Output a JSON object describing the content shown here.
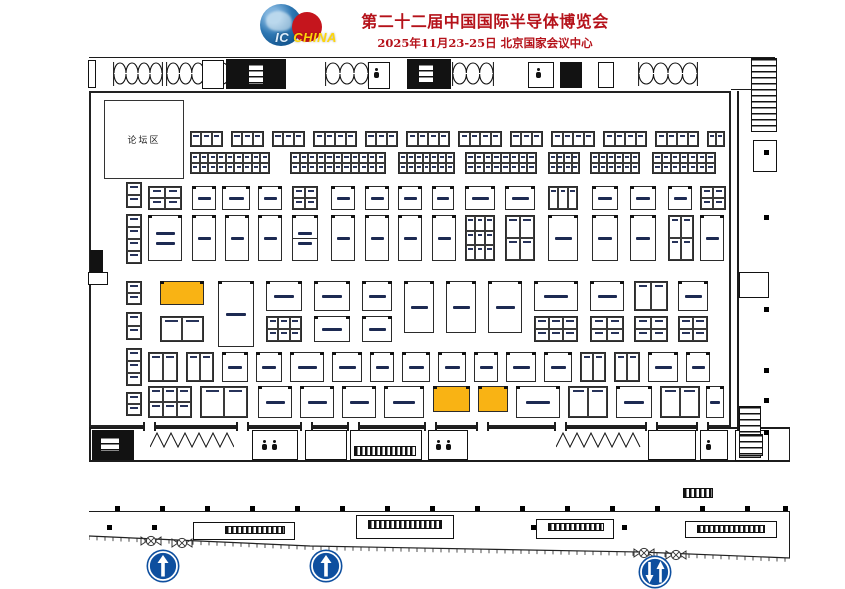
{
  "header": {
    "logo_ic": "IC ",
    "logo_china": "CHINA",
    "title": "第二十二届中国国际半导体博览会",
    "subtitle": "2025年11月23-25日  北京国家会议中心"
  },
  "colors": {
    "title_red": "#b5121a",
    "highlight": "#f9b314",
    "sign_blue": "#0e4f9f",
    "line": "#1c1c1c"
  },
  "plan": {
    "forum": {
      "label": "论坛区",
      "x": 104,
      "y": 100,
      "w": 78,
      "h": 77
    },
    "scale_label": "100m",
    "scale_pos": {
      "x": 386,
      "y": 450
    },
    "hall": {
      "x": 89,
      "y": 91,
      "w": 642,
      "h": 336
    },
    "strips": [
      {
        "x": 126,
        "y": 182,
        "w": 16,
        "h": 26,
        "rows": 2
      },
      {
        "x": 126,
        "y": 214,
        "w": 16,
        "h": 50,
        "rows": 4
      },
      {
        "x": 126,
        "y": 281,
        "w": 16,
        "h": 24,
        "rows": 2
      },
      {
        "x": 126,
        "y": 312,
        "w": 16,
        "h": 28,
        "rows": 2
      },
      {
        "x": 126,
        "y": 348,
        "w": 16,
        "h": 38,
        "rows": 3
      },
      {
        "x": 126,
        "y": 392,
        "w": 16,
        "h": 24,
        "rows": 2
      }
    ],
    "rows": [
      {
        "y": 131,
        "h": 16,
        "groups": [
          {
            "x": 190,
            "cols": 3
          },
          {
            "x": 231,
            "cols": 3
          },
          {
            "x": 272,
            "cols": 3
          },
          {
            "x": 313,
            "cols": 4
          },
          {
            "x": 365,
            "cols": 3
          },
          {
            "x": 406,
            "cols": 4
          },
          {
            "x": 458,
            "cols": 4
          },
          {
            "x": 510,
            "cols": 3
          },
          {
            "x": 551,
            "cols": 4
          },
          {
            "x": 603,
            "cols": 4
          },
          {
            "x": 655,
            "cols": 4
          },
          {
            "x": 707,
            "cols": 2,
            "cw": 9
          }
        ]
      },
      {
        "y": 152,
        "h": 22,
        "groups": [
          {
            "x": 190,
            "w": 80,
            "cols": 9,
            "rows": 2
          },
          {
            "x": 290,
            "w": 96,
            "cols": 11,
            "rows": 2
          },
          {
            "x": 398,
            "w": 57,
            "cols": 7,
            "rows": 2
          },
          {
            "x": 465,
            "w": 72,
            "cols": 8,
            "rows": 2
          },
          {
            "x": 548,
            "w": 32,
            "cols": 4,
            "rows": 2
          },
          {
            "x": 590,
            "w": 50,
            "cols": 6,
            "rows": 2
          },
          {
            "x": 652,
            "w": 64,
            "cols": 7,
            "rows": 2
          }
        ]
      },
      {
        "y": 186,
        "h": 24,
        "groups": [
          {
            "x": 148,
            "w": 34,
            "cols": 2,
            "rows": 2
          },
          {
            "x": 192,
            "w": 24,
            "lbl": 1
          },
          {
            "x": 222,
            "w": 28,
            "lbl": 1
          },
          {
            "x": 258,
            "w": 24,
            "lbl": 1
          },
          {
            "x": 292,
            "w": 26,
            "cols": 2,
            "rows": 2
          },
          {
            "x": 331,
            "w": 24,
            "lbl": 1
          },
          {
            "x": 365,
            "w": 24,
            "lbl": 1
          },
          {
            "x": 398,
            "w": 24,
            "lbl": 1
          },
          {
            "x": 432,
            "w": 22,
            "lbl": 1
          },
          {
            "x": 465,
            "w": 30,
            "lbl": 1
          },
          {
            "x": 505,
            "w": 30,
            "lbl": 1
          },
          {
            "x": 548,
            "w": 30,
            "cols": 3,
            "rows": 1
          },
          {
            "x": 592,
            "w": 26,
            "lbl": 1
          },
          {
            "x": 630,
            "w": 26,
            "lbl": 1
          },
          {
            "x": 668,
            "w": 24,
            "lbl": 1
          },
          {
            "x": 700,
            "w": 26,
            "cols": 2,
            "rows": 2
          }
        ]
      },
      {
        "y": 215,
        "h": 46,
        "groups": [
          {
            "x": 148,
            "w": 34,
            "lbl": 2
          },
          {
            "x": 192,
            "w": 24,
            "lbl": 1
          },
          {
            "x": 225,
            "w": 24,
            "lbl": 1
          },
          {
            "x": 258,
            "w": 24,
            "lbl": 1
          },
          {
            "x": 292,
            "w": 26,
            "lbl": 2,
            "split": true
          },
          {
            "x": 331,
            "w": 24,
            "lbl": 1
          },
          {
            "x": 365,
            "w": 24,
            "lbl": 1
          },
          {
            "x": 398,
            "w": 24,
            "lbl": 1
          },
          {
            "x": 432,
            "w": 24,
            "lbl": 1
          },
          {
            "x": 465,
            "w": 30,
            "cols": 3,
            "rows": 3
          },
          {
            "x": 505,
            "w": 30,
            "cols": 2,
            "rows": 2
          },
          {
            "x": 548,
            "w": 30,
            "lbl": 1
          },
          {
            "x": 592,
            "w": 26,
            "lbl": 1
          },
          {
            "x": 630,
            "w": 26,
            "lbl": 1
          },
          {
            "x": 668,
            "w": 26,
            "cols": 2,
            "rows": 2
          },
          {
            "x": 700,
            "w": 24,
            "lbl": 1
          }
        ]
      },
      {
        "y": 281,
        "h": 30,
        "groups": [
          {
            "x": 160,
            "w": 44,
            "h": 24,
            "hl": true
          },
          {
            "x": 218,
            "w": 36,
            "h": 66,
            "lbl": 1
          },
          {
            "x": 266,
            "w": 36,
            "lbl": 1
          },
          {
            "x": 314,
            "w": 36,
            "lbl": 1
          },
          {
            "x": 362,
            "w": 30,
            "lbl": 1
          },
          {
            "x": 404,
            "w": 30,
            "h": 52,
            "lbl": 1
          },
          {
            "x": 446,
            "w": 30,
            "h": 52,
            "lbl": 1
          },
          {
            "x": 488,
            "w": 34,
            "h": 52,
            "lbl": 1
          },
          {
            "x": 534,
            "w": 44,
            "lbl": 1
          },
          {
            "x": 590,
            "w": 34,
            "lbl": 1
          },
          {
            "x": 634,
            "w": 34,
            "cols": 2,
            "rows": 1
          },
          {
            "x": 678,
            "w": 30,
            "lbl": 1
          }
        ]
      },
      {
        "y": 316,
        "h": 26,
        "groups": [
          {
            "x": 160,
            "w": 44,
            "cols": 2,
            "rows": 1
          },
          {
            "x": 266,
            "w": 36,
            "cols": 3,
            "rows": 2
          },
          {
            "x": 314,
            "w": 36,
            "lbl": 1
          },
          {
            "x": 362,
            "w": 30,
            "lbl": 1
          },
          {
            "x": 534,
            "w": 44,
            "cols": 3,
            "rows": 2
          },
          {
            "x": 590,
            "w": 34,
            "cols": 2,
            "rows": 2
          },
          {
            "x": 634,
            "w": 34,
            "cols": 2,
            "rows": 2
          },
          {
            "x": 678,
            "w": 30,
            "cols": 2,
            "rows": 2
          }
        ]
      },
      {
        "y": 352,
        "h": 30,
        "groups": [
          {
            "x": 148,
            "w": 30,
            "cols": 2,
            "rows": 1
          },
          {
            "x": 186,
            "w": 28,
            "cols": 2,
            "rows": 1
          },
          {
            "x": 222,
            "w": 26,
            "lbl": 1
          },
          {
            "x": 256,
            "w": 26,
            "lbl": 1
          },
          {
            "x": 290,
            "w": 34,
            "lbl": 1
          },
          {
            "x": 332,
            "w": 30,
            "lbl": 1
          },
          {
            "x": 370,
            "w": 24,
            "lbl": 1
          },
          {
            "x": 402,
            "w": 28,
            "lbl": 1
          },
          {
            "x": 438,
            "w": 28,
            "lbl": 1
          },
          {
            "x": 474,
            "w": 24,
            "lbl": 1
          },
          {
            "x": 506,
            "w": 30,
            "lbl": 1
          },
          {
            "x": 544,
            "w": 28,
            "lbl": 1
          },
          {
            "x": 580,
            "w": 26,
            "cols": 2,
            "rows": 1
          },
          {
            "x": 614,
            "w": 26,
            "cols": 2,
            "rows": 1
          },
          {
            "x": 648,
            "w": 30,
            "lbl": 1
          },
          {
            "x": 686,
            "w": 24,
            "lbl": 1
          }
        ]
      },
      {
        "y": 386,
        "h": 32,
        "groups": [
          {
            "x": 148,
            "w": 44,
            "cols": 3,
            "rows": 2
          },
          {
            "x": 200,
            "w": 48,
            "cols": 2,
            "rows": 1
          },
          {
            "x": 258,
            "w": 34,
            "lbl": 1
          },
          {
            "x": 300,
            "w": 34,
            "lbl": 1
          },
          {
            "x": 342,
            "w": 34,
            "lbl": 1
          },
          {
            "x": 384,
            "w": 40,
            "lbl": 1
          },
          {
            "x": 433,
            "w": 37,
            "h": 26,
            "hl": true
          },
          {
            "x": 478,
            "w": 30,
            "h": 26,
            "hl": true
          },
          {
            "x": 516,
            "w": 44,
            "lbl": 1
          },
          {
            "x": 568,
            "w": 40,
            "cols": 2,
            "rows": 1
          },
          {
            "x": 616,
            "w": 36,
            "lbl": 1
          },
          {
            "x": 660,
            "w": 40,
            "cols": 2,
            "rows": 1
          },
          {
            "x": 706,
            "w": 18,
            "lbl": 1
          }
        ]
      }
    ],
    "arc_clusters": [
      {
        "x": 113,
        "y": 60,
        "w": 50
      },
      {
        "x": 166,
        "y": 60,
        "w": 64
      },
      {
        "x": 325,
        "y": 60,
        "w": 44
      },
      {
        "x": 452,
        "y": 60,
        "w": 42
      },
      {
        "x": 638,
        "y": 60,
        "w": 60
      }
    ],
    "top_dark": [
      {
        "x": 226,
        "y": 59,
        "w": 60,
        "h": 30
      },
      {
        "x": 407,
        "y": 59,
        "w": 44,
        "h": 30
      },
      {
        "x": 560,
        "y": 62,
        "w": 22,
        "h": 26
      }
    ],
    "top_boxes": [
      {
        "x": 202,
        "y": 60,
        "w": 22,
        "h": 29
      },
      {
        "x": 368,
        "y": 62,
        "w": 22,
        "h": 27
      },
      {
        "x": 528,
        "y": 62,
        "w": 26,
        "h": 26
      },
      {
        "x": 598,
        "y": 62,
        "w": 16,
        "h": 26
      },
      {
        "x": 88,
        "y": 60,
        "w": 8,
        "h": 28
      }
    ],
    "top_insets": [
      {
        "x": 248,
        "y": 63,
        "w": 16,
        "h": 22
      },
      {
        "x": 418,
        "y": 63,
        "w": 16,
        "h": 20
      }
    ],
    "persons": [
      {
        "x": 374,
        "y": 68
      },
      {
        "x": 536,
        "y": 68
      },
      {
        "x": 262,
        "y": 440
      },
      {
        "x": 272,
        "y": 440
      },
      {
        "x": 436,
        "y": 440
      },
      {
        "x": 446,
        "y": 440
      },
      {
        "x": 706,
        "y": 440
      }
    ],
    "bottom_dark": [
      {
        "x": 92,
        "y": 430,
        "w": 42,
        "h": 30
      }
    ],
    "bottom_boxes": [
      {
        "x": 252,
        "y": 430,
        "w": 46,
        "h": 30
      },
      {
        "x": 305,
        "y": 430,
        "w": 42,
        "h": 30
      },
      {
        "x": 350,
        "y": 430,
        "w": 72,
        "h": 30
      },
      {
        "x": 428,
        "y": 430,
        "w": 40,
        "h": 30
      },
      {
        "x": 648,
        "y": 430,
        "w": 48,
        "h": 30
      },
      {
        "x": 700,
        "y": 430,
        "w": 28,
        "h": 30
      },
      {
        "x": 735,
        "y": 430,
        "w": 34,
        "h": 31
      }
    ],
    "bottom_stripes": [
      {
        "x": 354,
        "y": 446,
        "w": 62,
        "h": 10
      },
      {
        "x": 683,
        "y": 488,
        "w": 30,
        "h": 10
      }
    ],
    "rung_blocks": [
      {
        "x": 751,
        "y": 58,
        "w": 26,
        "h": 74
      },
      {
        "x": 739,
        "y": 406,
        "w": 22,
        "h": 52
      },
      {
        "x": 100,
        "y": 436,
        "w": 20,
        "h": 16
      },
      {
        "x": 739,
        "y": 434,
        "w": 24,
        "h": 22
      }
    ],
    "right_boxes": [
      {
        "x": 753,
        "y": 140,
        "w": 24,
        "h": 32
      },
      {
        "x": 739,
        "y": 272,
        "w": 30,
        "h": 26
      }
    ],
    "right_columns_y": [
      150,
      215,
      307,
      368,
      398,
      430
    ],
    "left_objects": {
      "dark": {
        "x": 90,
        "y": 250,
        "w": 13,
        "h": 22
      },
      "box": {
        "x": 88,
        "y": 272,
        "w": 20,
        "h": 13
      }
    },
    "zigzags": [
      {
        "x": 150,
        "y": 432,
        "w": 84,
        "h": 17
      },
      {
        "x": 556,
        "y": 432,
        "w": 88,
        "h": 17
      }
    ],
    "gap_ticks_x": [
      143,
      236,
      300,
      347,
      424,
      476,
      554,
      645,
      696
    ],
    "lines": [
      {
        "x": 89,
        "y": 57,
        "w": 686,
        "h": 1.2
      },
      {
        "x": 731,
        "y": 89,
        "w": 45,
        "h": 1.4
      },
      {
        "x": 737,
        "y": 91,
        "w": 1.5,
        "h": 370
      },
      {
        "x": 89,
        "y": 427,
        "w": 701,
        "h": 2
      },
      {
        "x": 89,
        "y": 460,
        "w": 701,
        "h": 1.5
      },
      {
        "x": 89,
        "y": 427,
        "w": 1.5,
        "h": 34
      },
      {
        "x": 788.5,
        "y": 427,
        "w": 1.5,
        "h": 34
      },
      {
        "x": 89,
        "y": 511,
        "w": 701,
        "h": 1.2
      },
      {
        "x": 788.8,
        "y": 511,
        "w": 1.2,
        "h": 47
      }
    ],
    "dots_row1_y": 506,
    "dots_row1": [
      115,
      160,
      205,
      250,
      295,
      340,
      385,
      430,
      475,
      520,
      565,
      610,
      655,
      700,
      745,
      783
    ],
    "dots_row2_y": 525,
    "dots_row2": [
      107,
      152,
      231,
      278,
      356,
      402,
      449,
      531,
      577,
      622,
      725,
      770
    ],
    "shelters": [
      {
        "x": 193,
        "y": 522,
        "w": 102,
        "h": 18,
        "ix": 225,
        "iy": 526,
        "iw": 60,
        "ih": 8
      },
      {
        "x": 356,
        "y": 515,
        "w": 98,
        "h": 24,
        "ix": 368,
        "iy": 520,
        "iw": 74,
        "ih": 9
      },
      {
        "x": 536,
        "y": 519,
        "w": 78,
        "h": 20,
        "ix": 548,
        "iy": 523,
        "iw": 56,
        "ih": 8
      },
      {
        "x": 685,
        "y": 521,
        "w": 92,
        "h": 17,
        "ix": 697,
        "iy": 525,
        "iw": 68,
        "ih": 8
      }
    ],
    "valves": [
      {
        "x": 140,
        "y": 534
      },
      {
        "x": 171,
        "y": 536
      },
      {
        "x": 633,
        "y": 546
      },
      {
        "x": 665,
        "y": 548
      }
    ],
    "curb": {
      "x": 89,
      "y": 528,
      "w": 702,
      "pts": [
        [
          0,
          8
        ],
        [
          221,
          18
        ],
        [
          551,
          24
        ],
        [
          701,
          30
        ]
      ]
    },
    "signs": [
      {
        "x": 146,
        "y": 549,
        "dir": "up"
      },
      {
        "x": 309,
        "y": 549,
        "dir": "up"
      },
      {
        "x": 638,
        "y": 555,
        "dir": "updown"
      }
    ]
  }
}
